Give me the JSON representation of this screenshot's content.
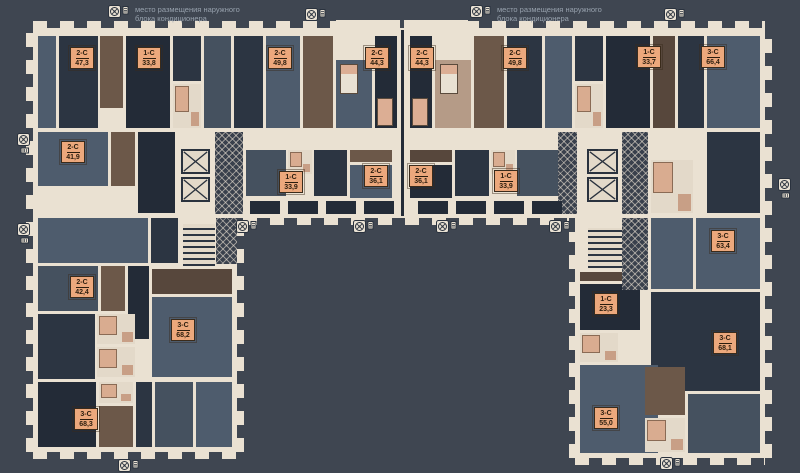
{
  "page": {
    "background": "#3F4651",
    "wall_color": "#EAE1D2",
    "label_color": "#ECA87C"
  },
  "legend": {
    "line1": "место размещения наружного",
    "line2": "блока кондиционера",
    "icon": "ac-outdoor-unit-icon"
  },
  "units": [
    {
      "code": "2-С",
      "area": "47,3"
    },
    {
      "code": "1-С",
      "area": "33,8"
    },
    {
      "code": "2-С",
      "area": "49,8"
    },
    {
      "code": "2-С",
      "area": "44,3"
    },
    {
      "code": "2-С",
      "area": "44,3"
    },
    {
      "code": "2-С",
      "area": "49,8"
    },
    {
      "code": "1-С",
      "area": "33,7"
    },
    {
      "code": "3-С",
      "area": "66,4"
    },
    {
      "code": "2-С",
      "area": "41,9"
    },
    {
      "code": "1-С",
      "area": "33,9"
    },
    {
      "code": "2-С",
      "area": "36,1"
    },
    {
      "code": "2-С",
      "area": "36,1"
    },
    {
      "code": "1-С",
      "area": "33,9"
    },
    {
      "code": "3-С",
      "area": "63,4"
    },
    {
      "code": "2-С",
      "area": "42,4"
    },
    {
      "code": "3-С",
      "area": "68,2"
    },
    {
      "code": "1-С",
      "area": "23,3"
    },
    {
      "code": "3-С",
      "area": "68,1"
    },
    {
      "code": "3-С",
      "area": "68,3"
    },
    {
      "code": "3-С",
      "area": "55,0"
    }
  ]
}
